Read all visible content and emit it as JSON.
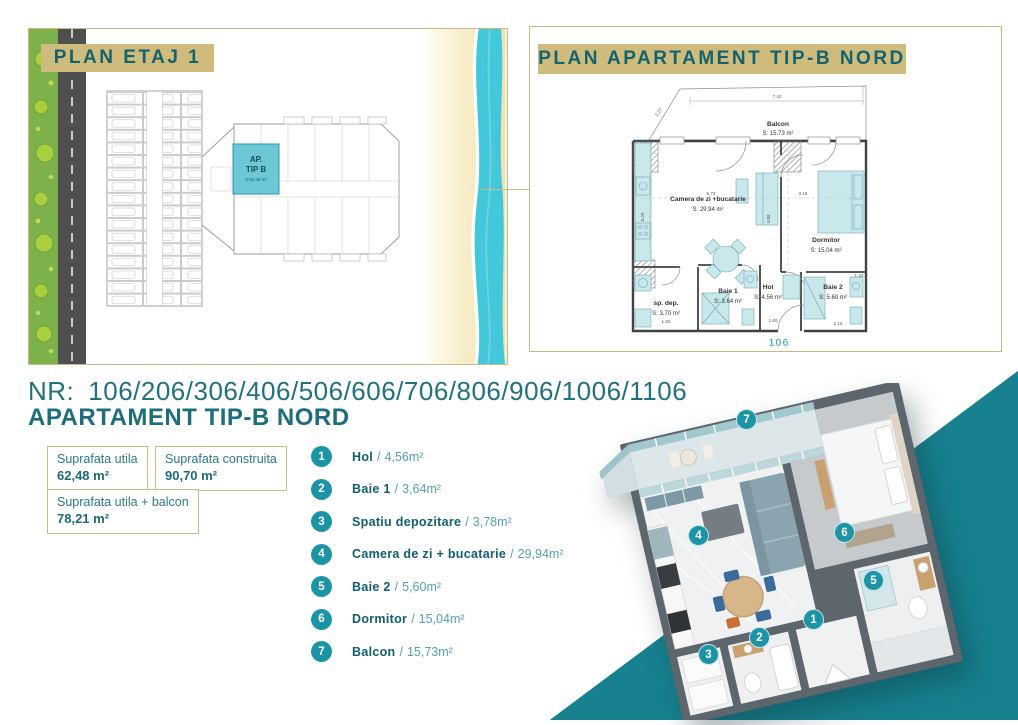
{
  "colors": {
    "accent_tan": "#cfbc7d",
    "teal_dark": "#15626f",
    "teal_text": "#1d6e7c",
    "teal_circle": "#1b95a6",
    "teal_triangle": "#17818f",
    "sea": "#43c7da",
    "sand": "#f3e3b2",
    "grass": "#7cb14c",
    "road": "#4f4f4f",
    "unit_highlight": "#63c3d3"
  },
  "left_panel": {
    "title": "PLAN ETAJ 1",
    "unit_label": {
      "line1": "AP.",
      "line2": "TIP B",
      "line3": "S:62,48 m²"
    }
  },
  "right_panel": {
    "title": "PLAN APARTAMENT TIP-B NORD",
    "unit_number": "106",
    "rooms": {
      "balcon": {
        "name": "Balcon",
        "area": "S: 15.73 m²"
      },
      "camera": {
        "name": "Camera de zi +bucatarie",
        "area": "S: 29.94 m²"
      },
      "dormitor": {
        "name": "Dormitor",
        "area": "S: 15.04 m²"
      },
      "hol": {
        "name": "Hol",
        "area": "S: 4.56 m²"
      },
      "baie1": {
        "name": "Baie 1",
        "area": "S: 3.64 m²"
      },
      "baie2": {
        "name": "Baie 2",
        "area": "S: 5.60 m²"
      },
      "sp_dep": {
        "name": "sp. dep.",
        "area": "S: 3.70 m²"
      }
    },
    "dims": {
      "balcon_w": "7.42",
      "balcon_diag": "2.27",
      "living_w": "5.73",
      "dorm_w": "3.16",
      "dorm_h": "4.68",
      "living_h": "5.20",
      "spdep_w": "1.83",
      "hol_w": "1.60",
      "baie2_w": "2.10",
      "baie2_r": "1.43"
    }
  },
  "info": {
    "nr_label": "NR:",
    "unit_numbers": "106/206/306/406/506/606/706/806/906/1006/1106",
    "subtitle": "APARTAMENT TIP-B NORD"
  },
  "legend_sep": "/",
  "area_boxes": [
    {
      "label": "Suprafata utila",
      "value": "62,48 m²"
    },
    {
      "label": "Suprafata construita",
      "value": "90,70 m²"
    },
    {
      "label": "Suprafata utila + balcon",
      "value": "78,21 m²"
    }
  ],
  "legend": [
    {
      "num": "1",
      "name": "Hol",
      "area": "4,56m²"
    },
    {
      "num": "2",
      "name": "Baie 1",
      "area": "3,64m²"
    },
    {
      "num": "3",
      "name": "Spatiu depozitare",
      "area": "3,78m²"
    },
    {
      "num": "4",
      "name": "Camera de zi + bucatarie",
      "area": "29,94m²"
    },
    {
      "num": "5",
      "name": "Baie 2",
      "area": "5,60m²"
    },
    {
      "num": "6",
      "name": "Dormitor",
      "area": "15,04m²"
    },
    {
      "num": "7",
      "name": "Balcon",
      "area": "15,73m²"
    }
  ]
}
